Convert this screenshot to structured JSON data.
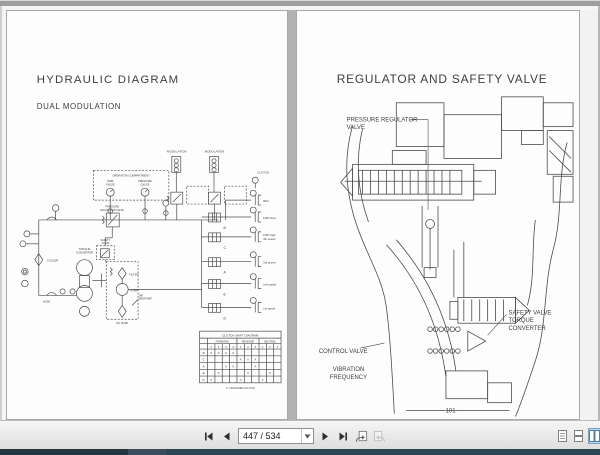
{
  "toolbar": {
    "page_field": "447 / 534",
    "icons": {
      "first": "first-page-icon",
      "previous": "previous-page-icon",
      "next": "next-page-icon",
      "last": "last-page-icon",
      "previous_view": "previous-view-icon",
      "next_view": "next-view-icon",
      "layout_single": "single-page-layout-icon",
      "layout_continuous": "continuous-layout-icon",
      "layout_facing": "facing-pages-layout-icon"
    }
  },
  "left_page": {
    "title": "HYDRAULIC DIAGRAM",
    "subtitle": "DUAL MODULATION",
    "labels": {
      "operator_compartment": "OPERATOR COMPARTMENT",
      "temp": "TEMP",
      "gauge1": "GAUGE",
      "pressure": "PRESSURE",
      "gauge2": "GAUGE",
      "pressure_regulator": "PRESSURE",
      "regulator_valve": "REGULATOR VALVE",
      "safety": "SAFETY",
      "safety_valve2": "VALVE",
      "cooler": "COOLER",
      "torque": "TORQUE",
      "converter": "CONVERTER",
      "filter": "FILTER",
      "pump": "PUMP",
      "oil_sump": "OIL SUMP",
      "air": "AIR",
      "breather": "BREATHER",
      "hose": "HOSE",
      "modulation_1": "MODULATION",
      "modulation_2": "MODULATION",
      "clutch": "CLUTCH",
      "rev": "REV",
      "fwd_slow": "FWD slow",
      "fwd_high": "FWD high",
      "speed4": "4th speed",
      "speed3": "3rd speed",
      "speed2": "2nd speed",
      "speed1": "1st speed",
      "valve_b": "B",
      "valve_c": "C",
      "valve_a": "A",
      "valve_e": "E",
      "valve_d": "D"
    },
    "table": {
      "title": "CLUTCH SHIFT DIAGRAM",
      "groups": [
        "FORWARD",
        "REVERSE",
        "NEUTRAL"
      ],
      "cols": [
        "1",
        "2",
        "3",
        "4",
        "1",
        "2",
        "3",
        "1",
        "2",
        "3"
      ],
      "rows": [
        {
          "label": "B",
          "marks": [
            "X",
            "X",
            "X",
            "X",
            "",
            "",
            "",
            "",
            "",
            ""
          ]
        },
        {
          "label": "C",
          "marks": [
            "",
            "",
            "",
            "",
            "X",
            "X",
            "X",
            "",
            "",
            ""
          ]
        },
        {
          "label": "A",
          "marks": [
            "",
            "",
            "X",
            "X",
            "",
            "",
            "X",
            "",
            "",
            ""
          ]
        },
        {
          "label": "E",
          "marks": [
            "",
            "X",
            "",
            "",
            "",
            "X",
            "",
            "",
            "X",
            ""
          ]
        },
        {
          "label": "D",
          "marks": [
            "X",
            "",
            "",
            "",
            "X",
            "",
            "",
            "X",
            "",
            ""
          ]
        }
      ],
      "note": "X = ENGAGED CLUTCH"
    }
  },
  "right_page": {
    "title": "REGULATOR AND SAFETY VALVE",
    "labels": {
      "pressure_regulator": "PRESSURE REGULATOR",
      "pressure_regulator_2": "VALVE",
      "control_valve": "CONTROL VALVE",
      "vibration": "VIBRATION",
      "frequency": "FREQUENCY",
      "safety_valve": "SAFETY VALVE",
      "torque": "TORQUE",
      "converter": "CONVERTER"
    },
    "page_number": "- 101 -"
  }
}
